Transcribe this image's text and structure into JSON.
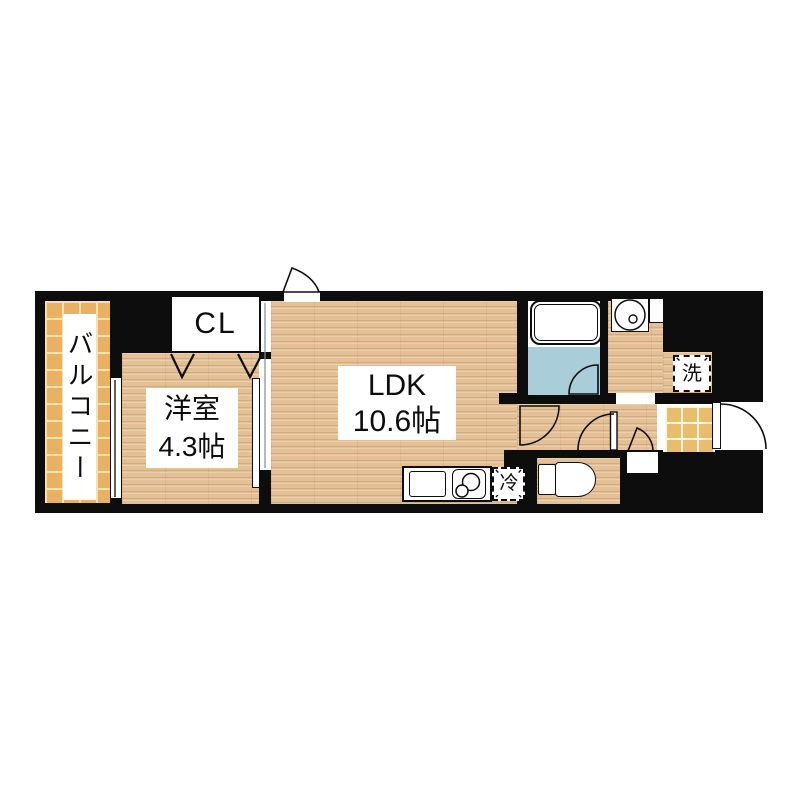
{
  "floor_plan": {
    "balcony_label": "バルコニー",
    "closet_label": "CL",
    "western_room": {
      "name": "洋室",
      "size": "4.3帖"
    },
    "ldk": {
      "name": "LDK",
      "size": "10.6帖"
    },
    "refrigerator_label": "冷",
    "washer_label": "洗",
    "fixtures": [
      "bathtub",
      "washbasin",
      "toilet",
      "kitchen-sink",
      "gas-stove",
      "refrigerator-space",
      "washer-space",
      "entrance-door",
      "closet-folding-doors",
      "room-sliding-partition",
      "balcony-window"
    ],
    "colors": {
      "wall": "#0d0d0d",
      "wood_floor": "#e4c096",
      "balcony_tile": "#e9b263",
      "tile_grid_line": "#f6e2ae",
      "entrance_tile": "#e8bd6e",
      "bathroom_floor": "#a9ced9",
      "fixture_white": "#ffffff"
    }
  }
}
